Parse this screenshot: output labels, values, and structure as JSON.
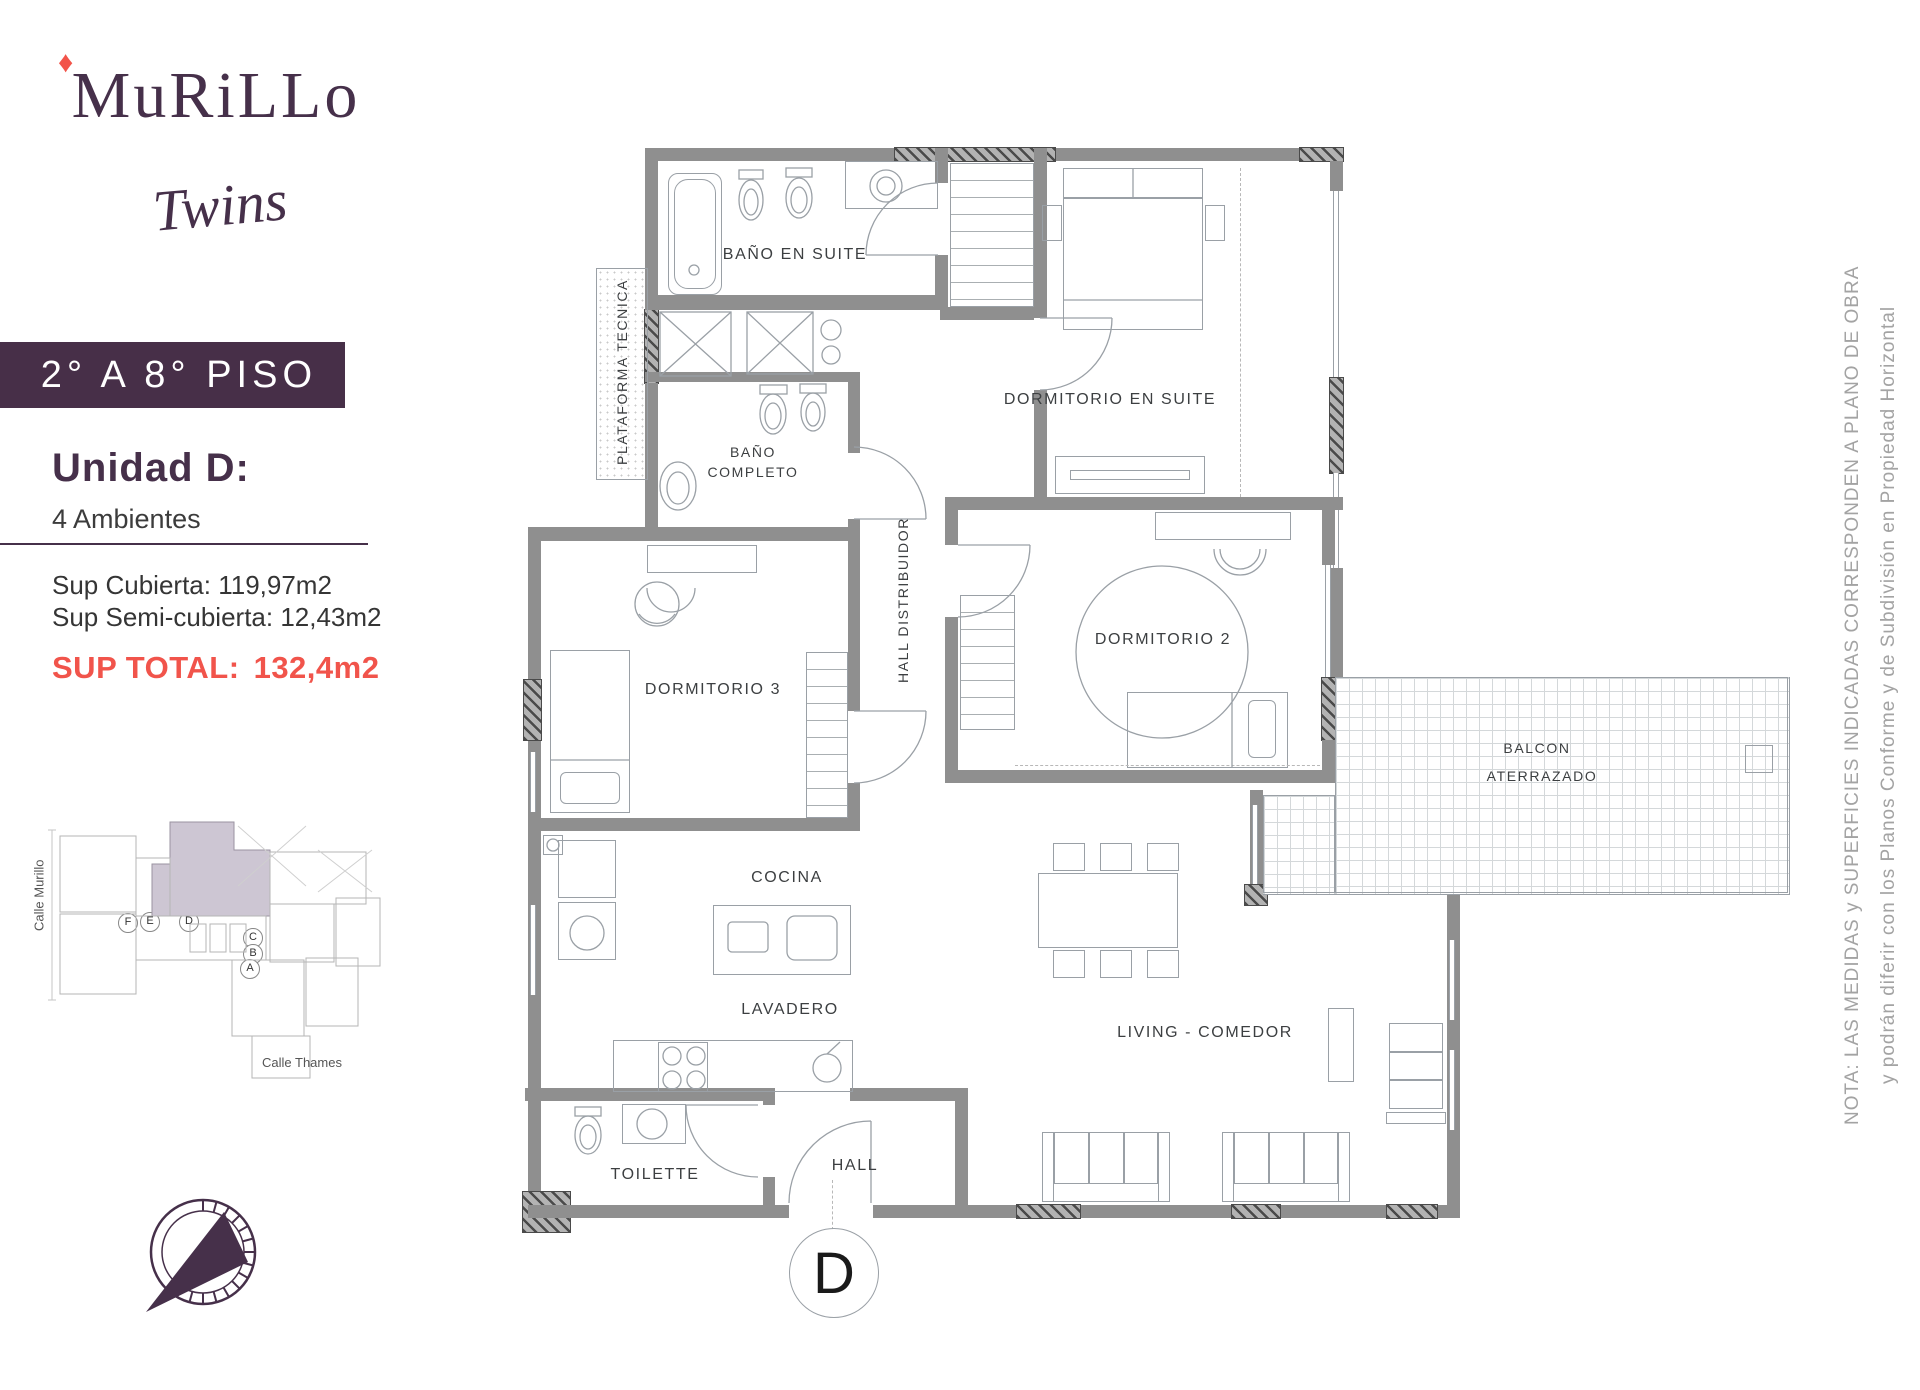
{
  "brand": {
    "logo_main": "MuRiLLo",
    "logo_sub": "Twins",
    "diamond_icon": "♦"
  },
  "floor_banner": "2° A 8° PISO",
  "unit_info": {
    "title": "Unidad D:",
    "subtitle": "4 Ambientes",
    "sup_cubierta": "Sup Cubierta: 119,97m2",
    "sup_semicubierta": "Sup Semi-cubierta: 12,43m2",
    "sup_total_label": "SUP TOTAL:",
    "sup_total_value": "132,4m2"
  },
  "site_plan": {
    "street_left": "Calle Murillo",
    "street_bottom": "Calle Thames",
    "unit_markers": [
      "F",
      "E",
      "D",
      "C",
      "B",
      "A"
    ]
  },
  "plan": {
    "unit_circle": "D",
    "labels": {
      "bano_en_suite": "BAÑO EN SUITE",
      "plataforma": "PLATAFORMA TECNICA",
      "bano_completo_l1": "BAÑO",
      "bano_completo_l2": "COMPLETO",
      "dormitorio_en_suite": "DORMITORIO EN SUITE",
      "hall_distribuidor": "HALL DISTRIBUIDOR",
      "dormitorio_2": "DORMITORIO 2",
      "dormitorio_3": "DORMITORIO 3",
      "balcon_l1": "BALCON",
      "balcon_l2": "ATERRAZADO",
      "cocina": "COCINA",
      "lavadero": "LAVADERO",
      "living": "LIVING - COMEDOR",
      "toilette": "TOILETTE",
      "hall": "HALL"
    }
  },
  "note": {
    "line1": "NOTA: LAS MEDIDAS y SUPERFICIES INDICADAS CORRESPONDEN A PLANO DE OBRA",
    "line2": "y podrán diferir con los Planos Conforme y de Subdivisión en Propiedad Horizontal"
  },
  "colors": {
    "brand_purple": "#472f48",
    "accent_red": "#f1544b",
    "wall_gray": "#8f8f8f",
    "note_gray": "#a3a3a3",
    "highlight_fill": "#cdc6d3"
  }
}
